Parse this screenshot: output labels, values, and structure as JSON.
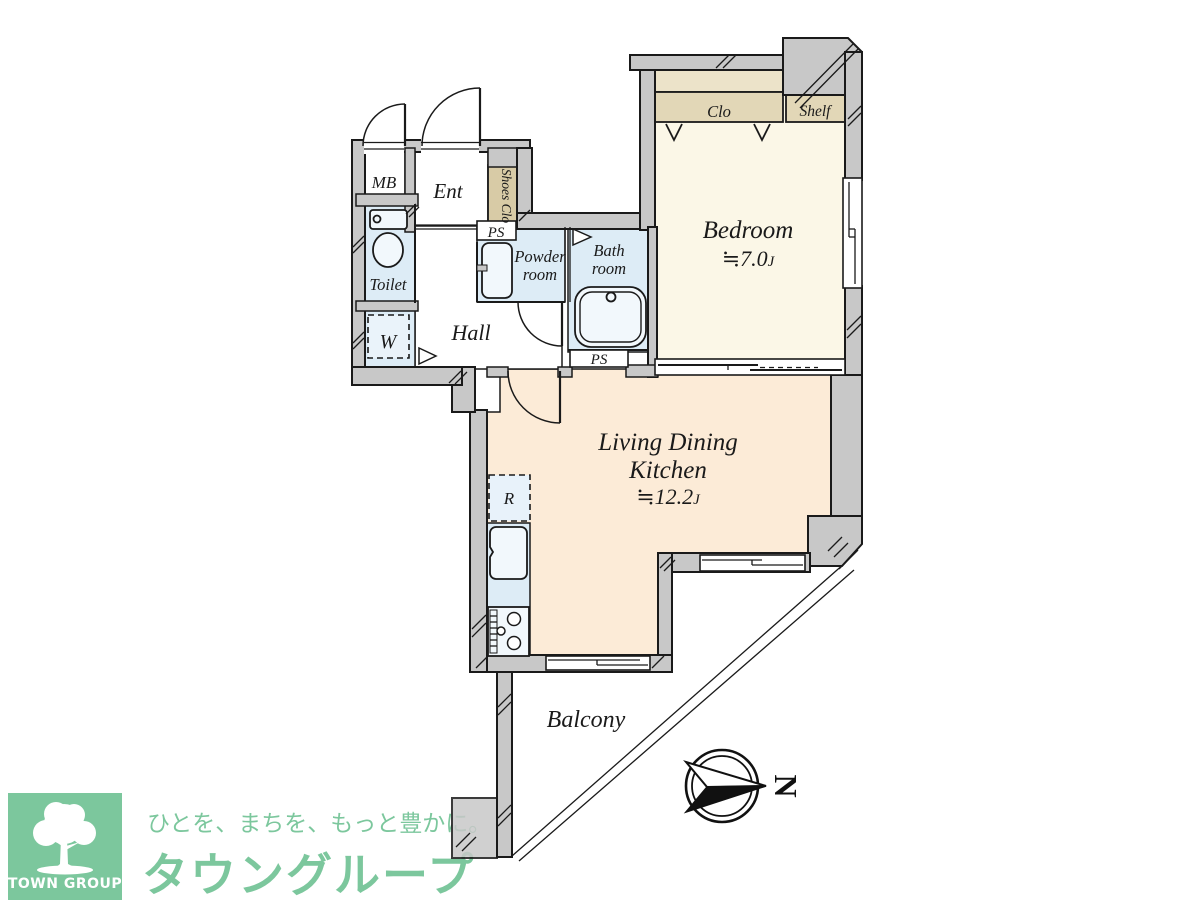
{
  "floorplan": {
    "labels": {
      "mb": "MB",
      "ent": "Ent",
      "shoes_clo": "Shoes Clo",
      "ps_top": "PS",
      "ps_bottom": "PS",
      "powder_line1": "Powder",
      "powder_line2": "room",
      "bath_line1": "Bath",
      "bath_line2": "room",
      "toilet": "Toilet",
      "washer": "W",
      "hall": "Hall",
      "clo": "Clo",
      "shelf": "Shelf",
      "bedroom": "Bedroom",
      "bedroom_area": "≒7.0",
      "bedroom_area_unit": "J",
      "ldk_line1": "Living Dining",
      "ldk_line2": "Kitchen",
      "ldk_area": "≒12.2",
      "ldk_area_unit": "J",
      "fridge": "R",
      "balcony": "Balcony",
      "north": "N"
    },
    "colors": {
      "wall": "#c8c8c8",
      "outline": "#1a1a1a",
      "bedroom_floor": "#fbf7e7",
      "ldk_floor": "#fcebd7",
      "wet_floor": "#ddecf6",
      "closet": "#e2d7b7",
      "closet_top": "#ece3c9",
      "shoes_closet": "#d8cba6"
    }
  },
  "logo": {
    "square_label": "TOWN GROUP",
    "tagline": "ひとを、まちを、もっと豊かに。",
    "brand": "タウングループ",
    "green": "#7cc79d"
  }
}
